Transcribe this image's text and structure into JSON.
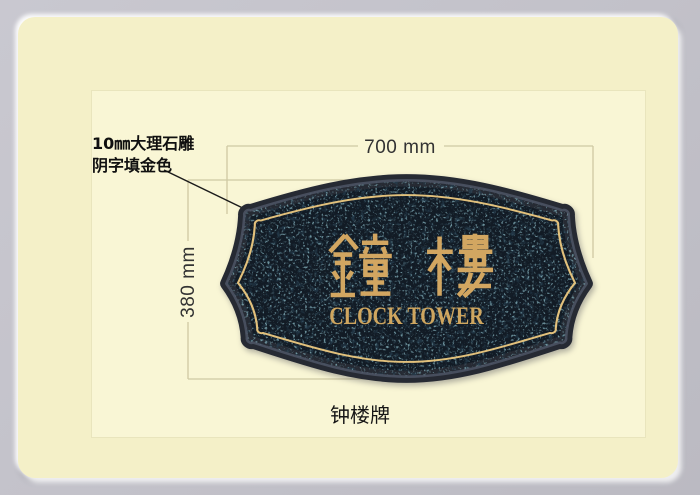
{
  "annotation": {
    "line1": "10㎜大理石雕",
    "line2": "阴字填金色"
  },
  "dimensions": {
    "width_label": "700 mm",
    "height_label": "380 mm"
  },
  "plaque": {
    "title": "鐘樓",
    "subtitle": "CLOCK TOWER"
  },
  "caption": "钟楼牌",
  "colors": {
    "background_gray": "#c3c2ca",
    "card_cream": "#f4f0c8",
    "panel_cream": "#f9f6d5",
    "dimension_line": "#cfc9a3",
    "leader_line": "#1b1b1b",
    "granite_base": "#121b25",
    "granite_speckle_teal": "#33616f",
    "granite_speckle_light": "#9fc3cf",
    "rim_dark": "#262a33",
    "gold_text": "#d2a661",
    "gold_pinstripe": "#e2c17c"
  }
}
